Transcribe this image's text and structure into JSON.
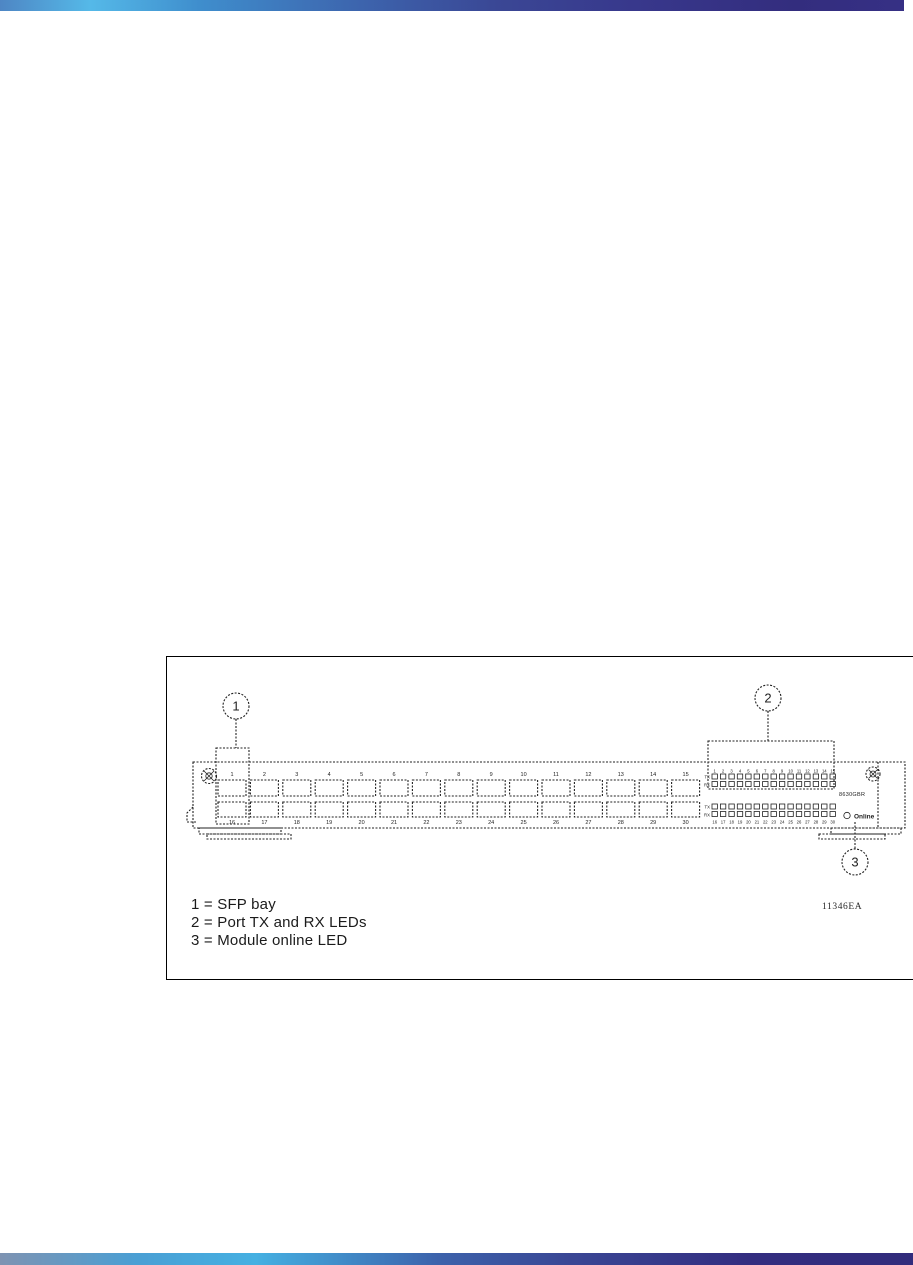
{
  "page": {
    "background": "#ffffff",
    "top_bar_stops": [
      [
        "#4e86c4",
        0
      ],
      [
        "#55b9e8",
        10
      ],
      [
        "#3f8ecd",
        22
      ],
      [
        "#3d64ad",
        40
      ],
      [
        "#3a4795",
        55
      ],
      [
        "#38388c",
        70
      ],
      [
        "#332d7e",
        88
      ],
      [
        "#363085",
        100
      ]
    ],
    "bottom_bar_stops": [
      [
        "#7e93b2",
        0
      ],
      [
        "#4a9fd4",
        15
      ],
      [
        "#45b0e2",
        28
      ],
      [
        "#3c62ab",
        48
      ],
      [
        "#3a4795",
        62
      ],
      [
        "#332d80",
        82
      ],
      [
        "#322c7c",
        100
      ]
    ]
  },
  "figure": {
    "legend_lines": [
      "1 = SFP bay",
      "2 = Port TX and RX LEDs",
      "3 = Module online LED"
    ],
    "figure_id": "11346EA",
    "callouts": {
      "one": "1",
      "two": "2",
      "three": "3"
    },
    "module": {
      "label": "8630GBR",
      "online_led_label": "Online",
      "tx_label": "TX",
      "rx_label": "RX",
      "sfp_rows": 2,
      "sfp_bays_per_row": 15,
      "led_columns": 15,
      "top_port_numbers": [
        "1",
        "2",
        "3",
        "4",
        "5",
        "6",
        "7",
        "8",
        "9",
        "10",
        "11",
        "12",
        "13",
        "14",
        "15"
      ],
      "bottom_port_numbers": [
        "16",
        "17",
        "18",
        "19",
        "20",
        "21",
        "22",
        "23",
        "24",
        "25",
        "26",
        "27",
        "28",
        "29",
        "30"
      ]
    }
  }
}
